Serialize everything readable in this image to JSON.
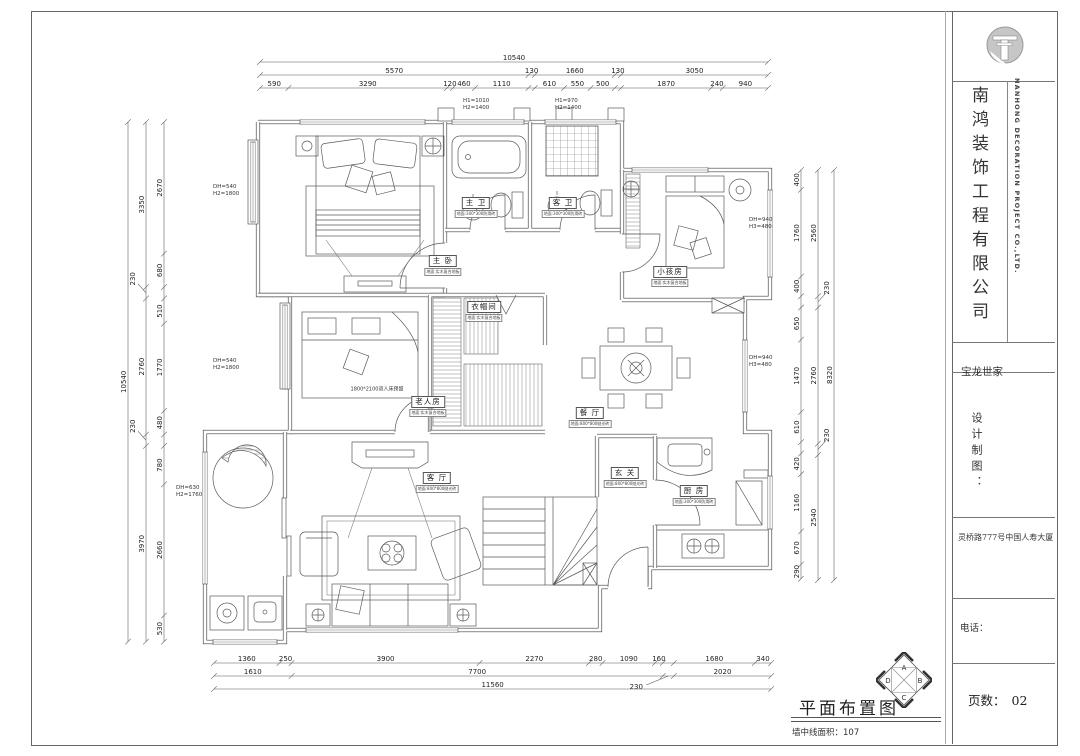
{
  "title_block": {
    "company_cn": "南鸿装饰工程有限公司",
    "company_en": "NANHONG DECORATION PROJECT CO.,LTD.",
    "project_name": "宝龙世家",
    "design_label": "设计制图：",
    "address": "灵桥路777号中国人寿大厦",
    "phone_label": "电话：",
    "page_label": "页数：",
    "page_number": "02"
  },
  "footer": {
    "drawing_title": "平面布置图",
    "area_label": "墙中线面积：",
    "area_value": "107"
  },
  "compass": {
    "top": "A",
    "right": "B",
    "bottom": "C",
    "left": "D"
  },
  "dimensions": {
    "top": {
      "total": "10540",
      "row2": [
        "5570",
        "130",
        "1660",
        "130",
        "3050"
      ],
      "row3": [
        "590",
        "3290",
        "120",
        "460",
        "1110",
        "610",
        "550",
        "500",
        "1870",
        "240",
        "940"
      ]
    },
    "bottom": {
      "row1": [
        "1360",
        "250",
        "3900",
        "2270",
        "280",
        "1090",
        "160",
        "1680",
        "340"
      ],
      "row2": [
        "1610",
        "7700",
        "230",
        "2020"
      ],
      "total": "11560"
    },
    "left": {
      "total": "10540",
      "outer": [
        "3350",
        "230",
        "2760",
        "230",
        "3970"
      ],
      "inner": [
        "2670",
        "680",
        "510",
        "1770",
        "480",
        "780",
        "2660",
        "530"
      ]
    },
    "right": {
      "total": "8320",
      "outer": [
        "2560",
        "230",
        "2760",
        "230",
        "2540"
      ],
      "inner": [
        "400",
        "1760",
        "400",
        "650",
        "1470",
        "610",
        "420",
        "1160",
        "670",
        "290"
      ]
    }
  },
  "window_annotations": [
    {
      "lines": [
        "H1=1010",
        "H2=1400"
      ]
    },
    {
      "lines": [
        "H1=970",
        "H2=1400"
      ]
    },
    {
      "lines": [
        "DH=540",
        "H2=1800"
      ]
    },
    {
      "lines": [
        "DH=540",
        "H2=1800"
      ]
    },
    {
      "lines": [
        "DH=630",
        "H2=1760"
      ]
    },
    {
      "lines": [
        "DH=940",
        "H3=480"
      ]
    },
    {
      "lines": [
        "DH=940",
        "H3=480"
      ]
    }
  ],
  "rooms": [
    {
      "name": "主 卧",
      "note": "地面:实木复合地板"
    },
    {
      "name": "主 卫",
      "note": "地面:300*300防滑砖"
    },
    {
      "name": "客 卫",
      "note": "地面:300*300防滑砖"
    },
    {
      "name": "小孩房",
      "note": "地面:实木复合地板"
    },
    {
      "name": "老人房",
      "note": "地面:实木复合地板"
    },
    {
      "name": "衣帽间",
      "note": "地面:实木复合地板"
    },
    {
      "name": "餐 厅",
      "note": "地面:800*800抛光砖"
    },
    {
      "name": "客 厅",
      "note": "地面:800*800抛光砖"
    },
    {
      "name": "玄 关",
      "note": "地面:800*800抛光砖"
    },
    {
      "name": "厨 房",
      "note": "地面:300*300防滑砖"
    }
  ],
  "plan_notes": [
    {
      "text": "1800*2100双人床预留"
    }
  ]
}
